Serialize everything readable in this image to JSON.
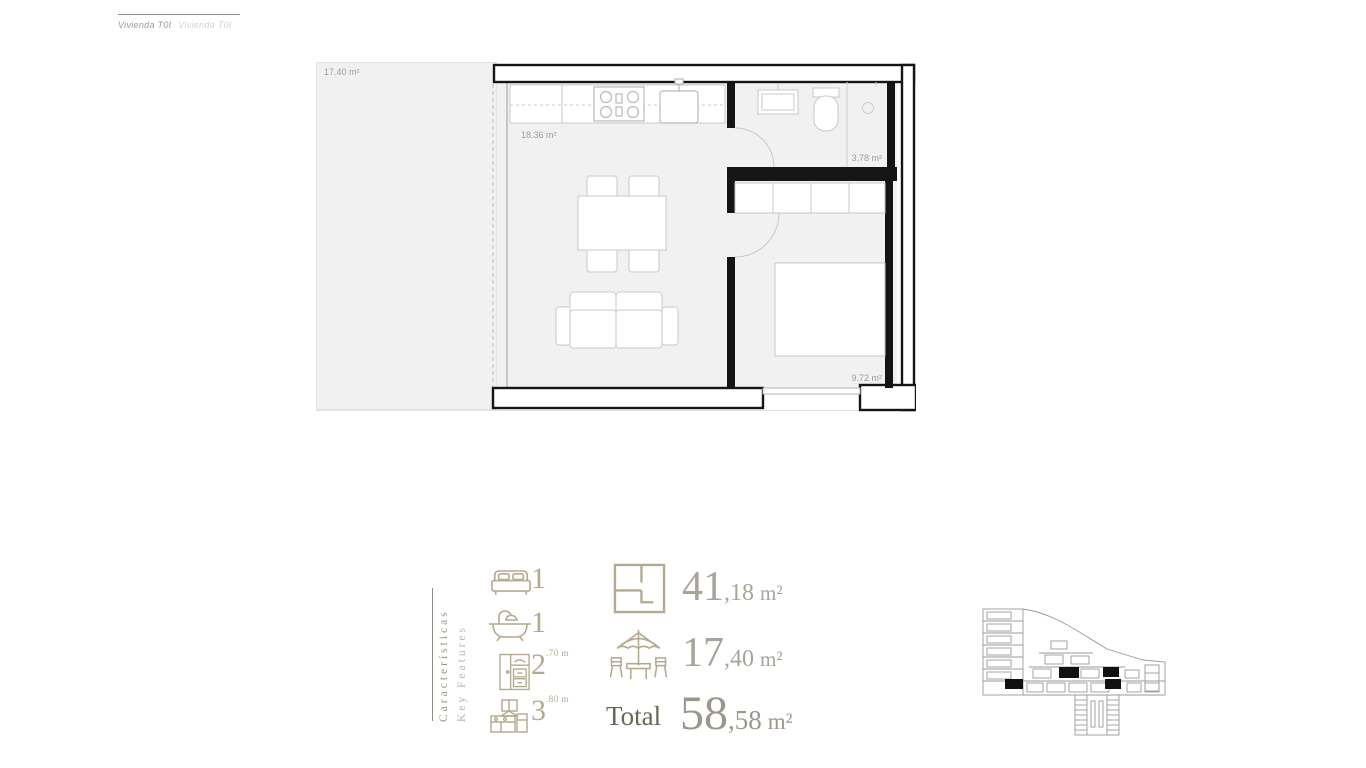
{
  "header": {
    "title_primary": "Vivienda T0I",
    "title_secondary": "Vivienda T0I"
  },
  "floorplan": {
    "labels": {
      "terrace": "17.40 m²",
      "living_kitchen": "18.36 m²",
      "bathroom": "3.78 m²",
      "bedroom": "9.72 m²"
    }
  },
  "features": {
    "heading_es": "Características",
    "heading_en": "Key Features",
    "counts": [
      {
        "name": "bedrooms",
        "icon": "bed-icon",
        "value": "1",
        "sup": ""
      },
      {
        "name": "bathrooms",
        "icon": "bath-icon",
        "value": "1",
        "sup": ""
      },
      {
        "name": "wardrobe",
        "icon": "wardrobe-icon",
        "value": "2",
        "sup": ".70 m"
      },
      {
        "name": "kitchen",
        "icon": "kitchen-icon",
        "value": "3",
        "sup": ".80 m"
      }
    ],
    "areas": [
      {
        "name": "interior-area",
        "icon": "floorplan-icon",
        "label": "",
        "int": "41",
        "dec": ",18",
        "unit": "m²"
      },
      {
        "name": "terrace-area",
        "icon": "parasol-icon",
        "label": "",
        "int": "17",
        "dec": ",40",
        "unit": "m²"
      },
      {
        "name": "total-area",
        "icon": "",
        "label": "Total",
        "int": "58",
        "dec": ",58",
        "unit": "m²"
      }
    ]
  },
  "colors": {
    "accent_beige": "#b3a98f",
    "number_gray": "#a8a49b",
    "total_label_gray": "#6b665c",
    "wall_black": "#151515",
    "room_fill": "#f1f1f1",
    "furniture_stroke": "#c9c9c9",
    "plan_label_gray": "#9c9c9c",
    "keyplan_stroke": "#9a9a9a",
    "keyplan_highlight": "#111111"
  }
}
